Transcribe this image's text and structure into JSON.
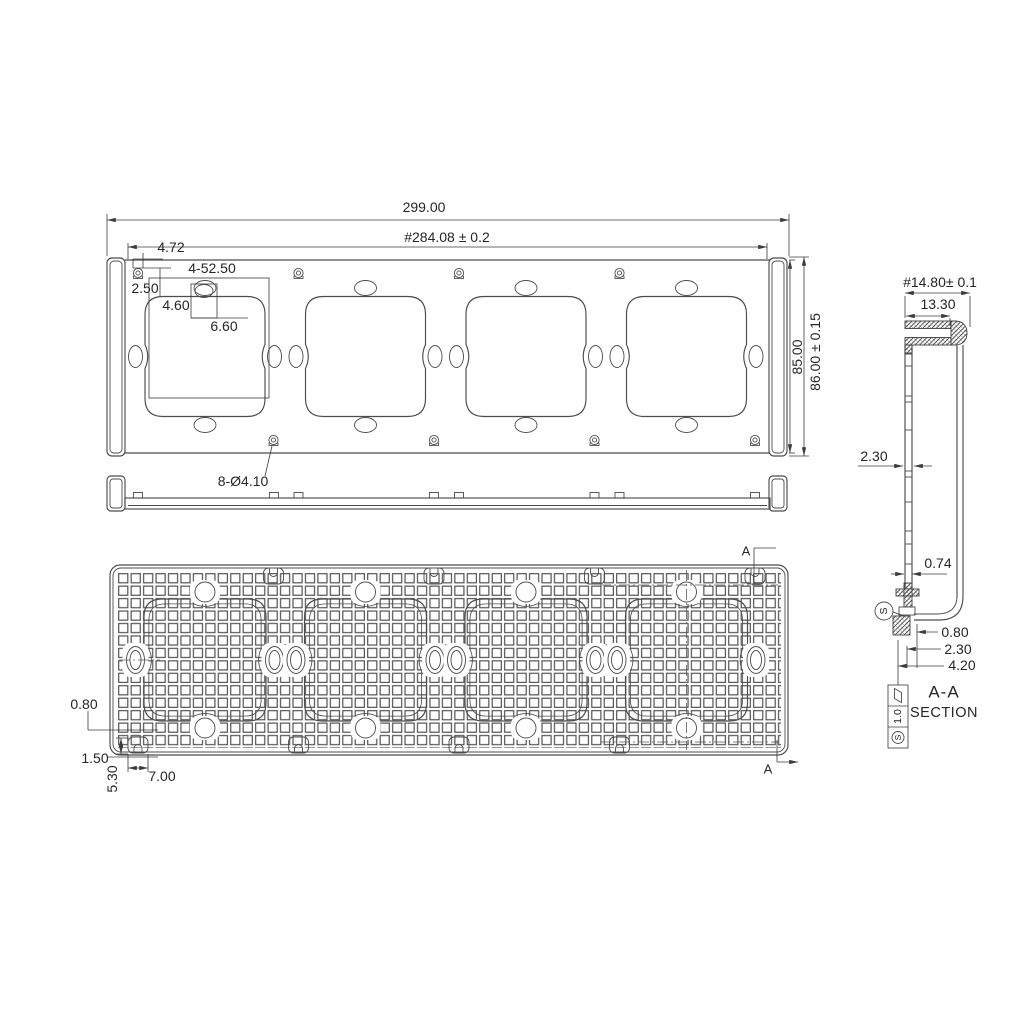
{
  "front": {
    "overall_width": "299.00",
    "inner_width": "#284.08 ± 0.2",
    "corner_offset": "4.72",
    "edge_gap": "2.50",
    "openings": "4-52.50",
    "notch_depth": "4.60",
    "notch_width": "6.60",
    "height": "85.00",
    "overall_height": "86.00 ± 0.15",
    "holes": "8-Ø4.10"
  },
  "back": {
    "rib": "0.80",
    "edge_rib": "1.50",
    "boss_h": "5.30",
    "boss_w": "7.00",
    "marker_top": "A",
    "marker_bottom": "A"
  },
  "section": {
    "depth": "#14.80± 0.1",
    "flange": "13.30",
    "wall": "2.30",
    "lip": "0.74",
    "s1": "0.80",
    "s2": "2.30",
    "s3": "4.20",
    "datum": "S",
    "gdt_val": "1.0",
    "gdt_datum": "S",
    "title": "A-A",
    "subtitle": "SECTION"
  }
}
